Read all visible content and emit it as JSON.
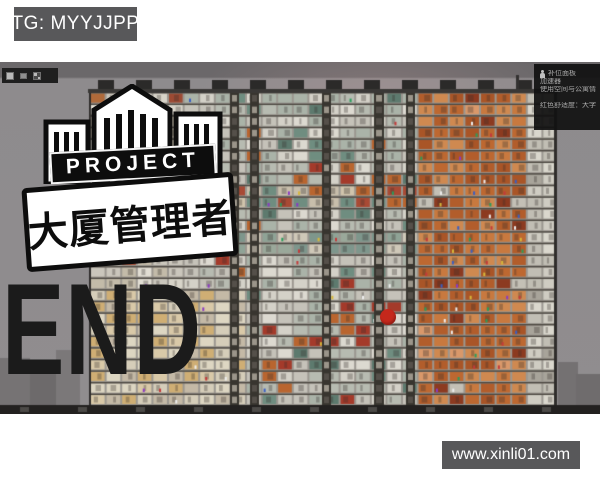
{
  "watermarks": {
    "tg_badge": {
      "text": "TG: MYYJJPP",
      "bg": "#58585a",
      "fg": "#ffffff"
    },
    "site_badge": {
      "text": "www.xinli01.com",
      "bg": "#58585a",
      "fg": "#ffffff"
    },
    "end_text": {
      "text": "END",
      "color": "#1b1b1b"
    }
  },
  "logo": {
    "banner_text": "PROJECT",
    "title_text": "大厦管理者",
    "banner_bg": "#0d0d0d",
    "banner_fg": "#ffffff",
    "plate_bg": "#ffffff",
    "plate_fg": "#0d0d0d"
  },
  "game": {
    "sky_color": "#8e8b8d",
    "sky_top_color": "#6b686a",
    "alert_dot_color": "#c5281c",
    "toolbar_icons": [
      {
        "name": "window-icon"
      },
      {
        "name": "resize-icon"
      },
      {
        "name": "grid-icon"
      }
    ],
    "tooltip": {
      "bg": "#111111",
      "icon": "person-icon",
      "lines": [
        "补位面板",
        "加速器",
        "使用空间与公寓情况",
        "红色舒适度：大字体"
      ]
    },
    "building": {
      "x0": 90,
      "x1": 556,
      "top": 30,
      "bottom": 343,
      "floor_h": 11.6,
      "cell_w": 15.6,
      "frame_color": "#9b9790",
      "slab_color": "rgba(68,63,56,0.9)",
      "edge_color": "#2f2d2b",
      "roofline_color": "#3a3836",
      "roof_units": {
        "color": "#2b2a29",
        "width": 16,
        "height": 9,
        "gap": 38
      },
      "antenna": {
        "x": 516,
        "w": 3,
        "h": 14,
        "color": "#333130"
      },
      "shafts": [
        {
          "x": 230,
          "w": 9
        },
        {
          "x": 250,
          "w": 9
        },
        {
          "x": 322,
          "w": 9
        },
        {
          "x": 374,
          "w": 10
        },
        {
          "x": 406,
          "w": 9
        }
      ],
      "shaft_color": "#38352f",
      "shaft_mark_light": "#9b958a",
      "shaft_mark_dark": "#55504a",
      "sections": [
        {
          "x0": 90,
          "x1": 170,
          "palette": [
            "#d8d4c9",
            "#cac6bc",
            "#e1ddd3",
            "#c3bba9"
          ],
          "accents": [
            "#b06a3a",
            "#9d4a33"
          ],
          "accent_p": 0.08
        },
        {
          "x0": 170,
          "x1": 410,
          "palette": [
            "#d4d1c8",
            "#c5c2b9",
            "#b7bbb1",
            "#dcd9d0",
            "#aab3a8"
          ],
          "accents": [
            "#6f8d80",
            "#b9652f",
            "#a43a2a",
            "#5d7a6e"
          ],
          "accent_p": 0.16
        },
        {
          "x0": 410,
          "x1": 525,
          "palette": [
            "#bd6831",
            "#c8793f",
            "#a95527",
            "#cf8950",
            "#b25d2b"
          ],
          "accents": [
            "#8c3a20",
            "#d9986a",
            "#c4c0b6"
          ],
          "accent_p": 0.14
        },
        {
          "x0": 525,
          "x1": 556,
          "palette": [
            "#cfccc2",
            "#c1beb4",
            "#dad7cd"
          ],
          "accents": [
            "#a8a49a"
          ],
          "accent_p": 0.1
        }
      ],
      "bands": [
        {
          "x0": 170,
          "x1": 410,
          "y0": 118,
          "y1": 140,
          "palette": [
            "#a84a35",
            "#b9652f",
            "#6f8d80",
            "#c8beab",
            "#d0c4ac"
          ],
          "people": true
        },
        {
          "x0": 170,
          "x1": 410,
          "y0": 164,
          "y1": 188,
          "palette": [
            "#7e968c",
            "#8fa396",
            "#cfc8b8",
            "#9aa89a"
          ],
          "people": true
        },
        {
          "x0": 90,
          "x1": 232,
          "y0": 226,
          "y1": 343,
          "palette": [
            "#ddd6c2",
            "#d9c9a8",
            "#cfae74",
            "#c4b9a6",
            "#d5cdb9"
          ],
          "people": false
        }
      ],
      "people_colors": [
        "#c33a3a",
        "#3a5fc3",
        "#d8b83a",
        "#eeeeee",
        "#8a3ac3",
        "#2a9d5c"
      ],
      "bottom_band": {
        "y": 343,
        "h": 9,
        "color": "#232120",
        "notch_color": "#4c4a47",
        "notch_gap": 58
      },
      "city": [
        {
          "x": 0,
          "y": 296,
          "w": 30,
          "h": 47,
          "color": "#767374"
        },
        {
          "x": 30,
          "y": 310,
          "w": 26,
          "h": 33,
          "color": "#6d6a6b"
        },
        {
          "x": 56,
          "y": 288,
          "w": 24,
          "h": 55,
          "color": "#7b7879"
        },
        {
          "x": 558,
          "y": 300,
          "w": 20,
          "h": 43,
          "color": "#747172"
        },
        {
          "x": 576,
          "y": 312,
          "w": 24,
          "h": 31,
          "color": "#6f6c6d"
        }
      ]
    }
  }
}
